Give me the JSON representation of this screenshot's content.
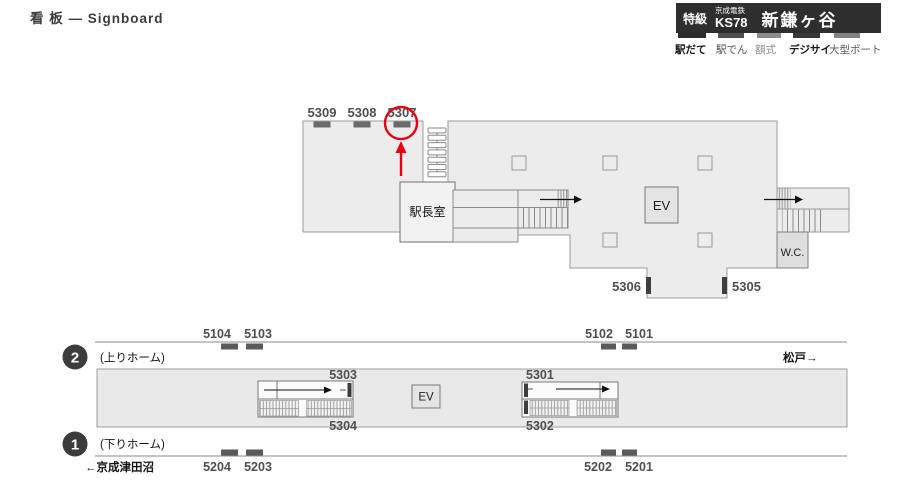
{
  "title": "看 板 — Signboard",
  "header": {
    "grade": "特級",
    "company": "京成電鉄",
    "station_code": "KS78",
    "station_name": "新鎌ヶ谷",
    "tabs": [
      {
        "label": "駅だて"
      },
      {
        "label": "駅でん"
      },
      {
        "label": "額式"
      },
      {
        "label": "デジサイ"
      },
      {
        "label": "大型ポート"
      }
    ]
  },
  "concourse": {
    "top_signs": [
      "5309",
      "5308",
      "5307"
    ],
    "highlighted_sign": "5307",
    "office_label": "駅長室",
    "elevator_label": "EV",
    "wc_label": "W.C.",
    "exit_signs": [
      "5306",
      "5305"
    ]
  },
  "platform": {
    "upper_number": "2",
    "upper_label": "(上りホーム)",
    "direction_right": "松戸→",
    "upper_track_signs": [
      "5104",
      "5103",
      "5102",
      "5101"
    ],
    "stair_signs_right_block": [
      "5303",
      "5304"
    ],
    "stair_signs_left_block": [
      "5301",
      "5302"
    ],
    "elevator_label": "EV",
    "lower_number": "1",
    "lower_label": "(下りホーム)",
    "direction_left": "←京成津田沼",
    "lower_track_signs": [
      "5204",
      "5203",
      "5202",
      "5201"
    ]
  },
  "colors": {
    "header_bg": "#2e2e2e",
    "floor": "#ececec",
    "accent_red": "#e60012",
    "sign_bar": "#5a5a5a"
  }
}
